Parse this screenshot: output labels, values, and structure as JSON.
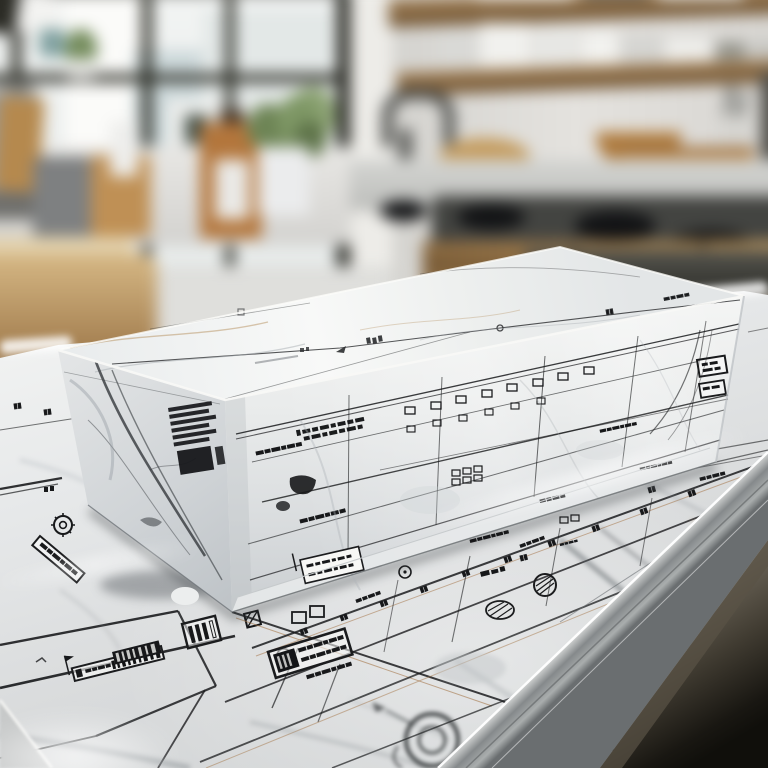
{
  "meta": {
    "description": "Photorealistic render: a rectangular slab of white marble printed with architectural blueprint drawings sits on a marble countertop that is itself covered in blueprint plan linework, in a bright modern kitchen that is softly blurred in the background.",
    "style": "shallow depth of field photograph, no legible text — all printed annotations are illegible blueprint micro-text"
  },
  "background": {
    "label": "blurred kitchen background",
    "objects": [
      {
        "label": "black-framed window wall with daylight"
      },
      {
        "label": "open wooden shelves with white dishware"
      },
      {
        "label": "gas cooktop with dark burners"
      },
      {
        "label": "wooden cabinet drawers"
      },
      {
        "label": "kitchen faucet"
      },
      {
        "label": "round wooden cutting board"
      },
      {
        "label": "amber bottle with white label"
      },
      {
        "label": "potted green plant"
      },
      {
        "label": "grey kettle and canisters"
      },
      {
        "label": "utensil crock with tools"
      }
    ]
  },
  "subject": {
    "label": "marble block printed with blueprint elevation drawings",
    "faces": [
      {
        "label": "top face with faint survey lines, node symbols and gold-grey veining"
      },
      {
        "label": "left face with strong dark marble veins and an illegible ink stamp block"
      },
      {
        "label": "front face with building elevation rows, window grids, dimension lines and illegible stamps"
      }
    ],
    "stamps_illegible": true
  },
  "countertop": {
    "label": "marble countertop printed as a blueprint sheet",
    "features": [
      {
        "label": "bold plan rectangle with flag-and-bar title stamp (illegible)"
      },
      {
        "label": "rotated bold title-block stamp (illegible)"
      },
      {
        "label": "white framed stamp near block base (illegible)"
      },
      {
        "label": "flower-target circle symbol"
      },
      {
        "label": "parallel perspective plan lines with tick marks"
      },
      {
        "label": "hatched circle and oval symbols"
      },
      {
        "label": "soft-focus compass circle symbol"
      },
      {
        "label": "polished silver bevel edge of the counter"
      },
      {
        "label": "sheet corner edge at bottom left"
      }
    ]
  },
  "floor": {
    "label": "dark kitchen floor visible beyond the counter edge"
  },
  "palette": {
    "marble_white": "#f2f3f4",
    "vein_grey": "#9aa0a6",
    "vein_dark": "#3f4347",
    "vein_gold": "#b08a55",
    "ink": "#17181a",
    "wood": "#a3804f",
    "wood_dark": "#6b4f2e",
    "counter_grey": "#cfd2d3",
    "stove_dark": "#1e2022",
    "floor_dark": "#17140e",
    "window_frame": "#26271f",
    "plant_green": "#6f8756",
    "silver_edge": "#dfe1e0"
  },
  "text": {
    "note": "every printed character in the image is illegible pseudo-text"
  }
}
